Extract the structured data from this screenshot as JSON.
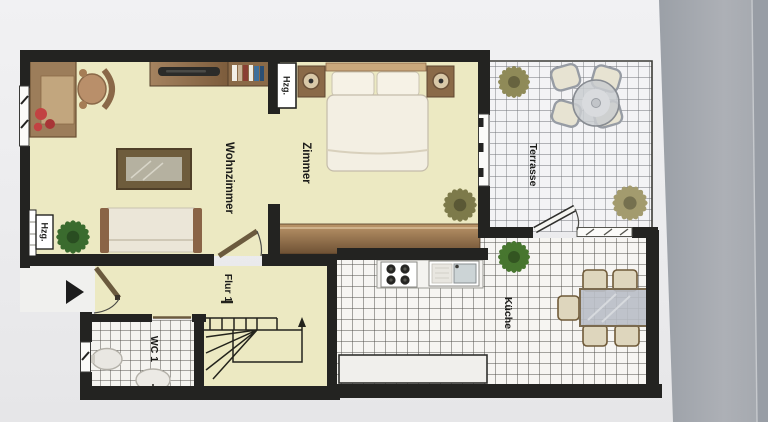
{
  "scene": {
    "description": "Photographed architectural floor plan (Grundriss) lying on a gray surface, plan labels rotated 90 degrees"
  },
  "rooms": {
    "wohnzimmer": {
      "label": "Wohnzimmer"
    },
    "zimmer": {
      "label": "Zimmer"
    },
    "flur": {
      "label": "Flur 1"
    },
    "wc": {
      "label": "WC 1"
    },
    "kueche": {
      "label": "Küche"
    },
    "terrasse": {
      "label": "Terrasse"
    }
  },
  "radiators": {
    "zimmer_wall_label": "Hzg.",
    "wohnzimmer_wall_label": "Hzg."
  },
  "furniture": {
    "wohnzimmer": [
      "desk",
      "office-chair",
      "red-flowers",
      "tv-sideboard",
      "bookshelf",
      "coffee-table",
      "sofa",
      "plant"
    ],
    "zimmer": [
      "double-bed",
      "nightstand-left",
      "nightstand-right",
      "bed-lamps",
      "wardrobe",
      "plant"
    ],
    "flur": [
      "staircase",
      "entrance-door"
    ],
    "wc": [
      "washbasin",
      "toilet"
    ],
    "kueche": [
      "stove-4-burners",
      "sink-unit",
      "counter",
      "dining-table",
      "five-chairs",
      "plant"
    ],
    "terrasse": [
      "round-table",
      "four-chairs",
      "plant-north",
      "plant-south"
    ]
  },
  "symbols": {
    "entrance_arrow": "entry-direction-right",
    "stairs_arrow": "stairs-up"
  },
  "colors": {
    "floor_yellow": "#ece9c2",
    "wall_dark": "#232321",
    "paper": "#ededef",
    "backdrop_gray": "#a7abb1",
    "wood_brown": "#8a6a48",
    "tile_white": "#f6f5f2",
    "plant_green": "#3a6b2e",
    "accent_red": "#c24242"
  }
}
